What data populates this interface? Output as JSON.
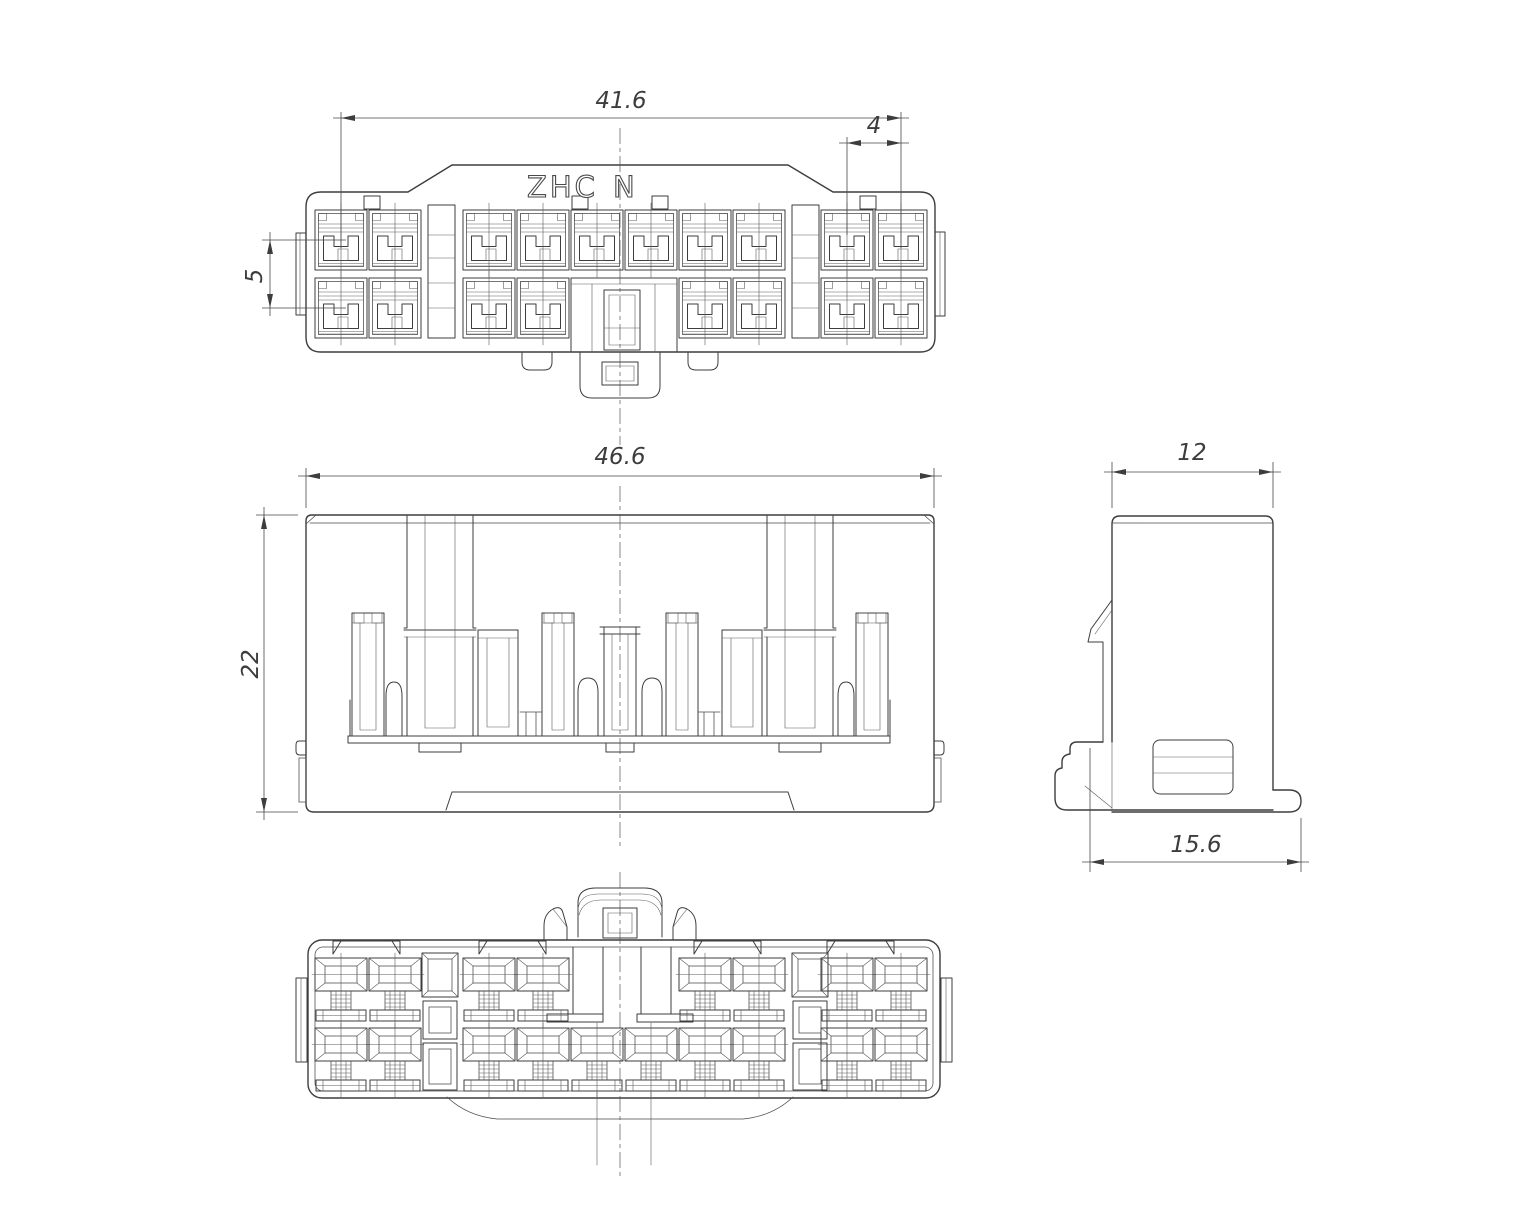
{
  "page": {
    "background": "#ffffff"
  },
  "drawing": {
    "line_color": "#3d3d3d",
    "marking_left": "ZHC",
    "marking_right": "N",
    "dims": {
      "top_overall_width": "41.6",
      "cavity_pitch": "4",
      "row_pitch": "5",
      "front_overall_width": "46.6",
      "front_height": "22",
      "side_width": "12",
      "side_depth": "15.6"
    }
  }
}
